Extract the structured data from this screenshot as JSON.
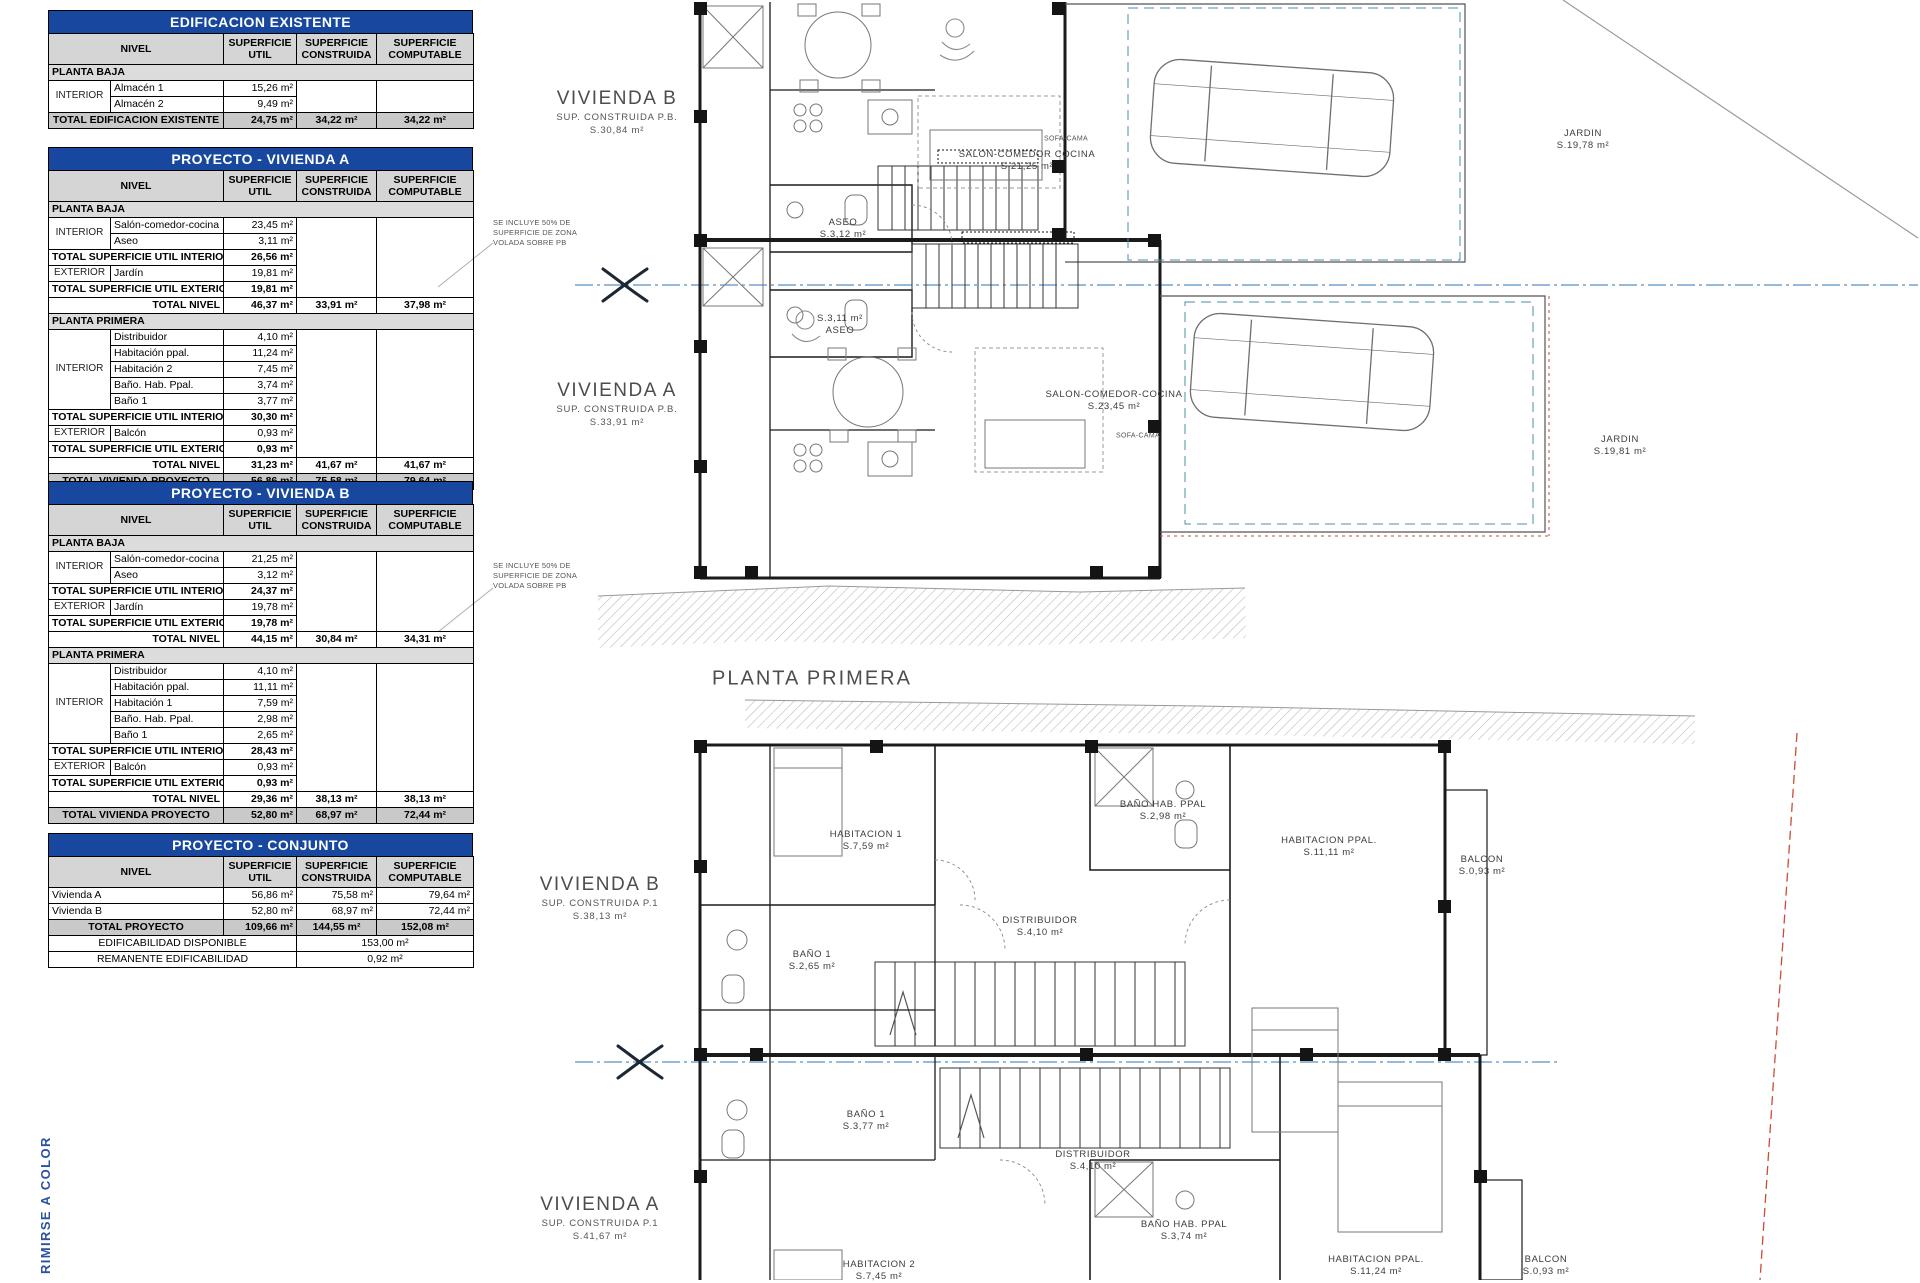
{
  "colors": {
    "accent_blue": "#17479e",
    "section_line_blue": "#2f74b5",
    "boundary_teal": "#4b8ca8",
    "boundary_red": "#cf4a38"
  },
  "side_note": "RIMIRSE A COLOR",
  "annotations": [
    {
      "x": 493,
      "y": 218,
      "lines": [
        "SE INCLUYE 50% DE",
        "SUPERFICIE DE ZONA",
        "VOLADA SOBRE PB"
      ]
    },
    {
      "x": 493,
      "y": 561,
      "lines": [
        "SE INCLUYE 50% DE",
        "SUPERFICIE DE ZONA",
        "VOLADA SOBRE PB"
      ]
    }
  ],
  "tables": [
    {
      "title": "EDIFICACION EXISTENTE",
      "headers": [
        "NIVEL",
        "SUPERFICIE UTIL",
        "SUPERFICIE CONSTRUIDA",
        "SUPERFICIE COMPUTABLE"
      ],
      "rows": [
        {
          "t": "section",
          "label": "PLANTA BAJA"
        },
        {
          "t": "item",
          "group": "INTERIOR",
          "gspan": 2,
          "name": "Almacén 1",
          "util": "15,26 m²",
          "cspan": 2
        },
        {
          "t": "item",
          "name": "Almacén 2",
          "util": "9,49 m²"
        },
        {
          "t": "grand",
          "label": "TOTAL EDIFICACION EXISTENTE",
          "util": "24,75 m²",
          "construida": "34,22 m²",
          "computable": "34,22 m²"
        }
      ]
    },
    {
      "title": "PROYECTO - VIVIENDA A",
      "headers": [
        "NIVEL",
        "SUPERFICIE UTIL",
        "SUPERFICIE CONSTRUIDA",
        "SUPERFICIE COMPUTABLE"
      ],
      "rows": [
        {
          "t": "section",
          "label": "PLANTA BAJA"
        },
        {
          "t": "item",
          "group": "INTERIOR",
          "gspan": 2,
          "name": "Salón-comedor-cocina",
          "util": "23,45 m²",
          "cspan": 5
        },
        {
          "t": "item",
          "name": "Aseo",
          "util": "3,11 m²"
        },
        {
          "t": "subtotal",
          "label": "TOTAL SUPERFICIE UTIL INTERIOR",
          "util": "26,56 m²"
        },
        {
          "t": "item",
          "group": "EXTERIOR",
          "gspan": 1,
          "name": "Jardín",
          "util": "19,81 m²"
        },
        {
          "t": "subtotal",
          "label": "TOTAL SUPERFICIE UTIL EXTERIOR",
          "util": "19,81 m²"
        },
        {
          "t": "level",
          "label": "TOTAL NIVEL",
          "util": "46,37 m²",
          "construida": "33,91 m²",
          "computable": "37,98 m²"
        },
        {
          "t": "section",
          "label": "PLANTA PRIMERA"
        },
        {
          "t": "item",
          "group": "INTERIOR",
          "gspan": 5,
          "name": "Distribuidor",
          "util": "4,10 m²",
          "cspan": 8
        },
        {
          "t": "item",
          "name": "Habitación ppal.",
          "util": "11,24 m²"
        },
        {
          "t": "item",
          "name": "Habitación 2",
          "util": "7,45 m²"
        },
        {
          "t": "item",
          "name": "Baño. Hab. Ppal.",
          "util": "3,74 m²"
        },
        {
          "t": "item",
          "name": "Baño 1",
          "util": "3,77 m²"
        },
        {
          "t": "subtotal",
          "label": "TOTAL SUPERFICIE UTIL INTERIOR",
          "util": "30,30 m²"
        },
        {
          "t": "item",
          "group": "EXTERIOR",
          "gspan": 1,
          "name": "Balcón",
          "util": "0,93 m²"
        },
        {
          "t": "subtotal",
          "label": "TOTAL SUPERFICIE UTIL EXTERIOR",
          "util": "0,93 m²"
        },
        {
          "t": "level",
          "label": "TOTAL NIVEL",
          "util": "31,23 m²",
          "construida": "41,67 m²",
          "computable": "41,67 m²"
        },
        {
          "t": "grand",
          "label": "TOTAL VIVIENDA PROYECTO",
          "util": "56,86 m²",
          "construida": "75,58 m²",
          "computable": "79,64 m²"
        }
      ]
    },
    {
      "title": "PROYECTO - VIVIENDA B",
      "headers": [
        "NIVEL",
        "SUPERFICIE UTIL",
        "SUPERFICIE CONSTRUIDA",
        "SUPERFICIE COMPUTABLE"
      ],
      "rows": [
        {
          "t": "section",
          "label": "PLANTA BAJA"
        },
        {
          "t": "item",
          "group": "INTERIOR",
          "gspan": 2,
          "name": "Salón-comedor-cocina",
          "util": "21,25 m²",
          "cspan": 5
        },
        {
          "t": "item",
          "name": "Aseo",
          "util": "3,12 m²"
        },
        {
          "t": "subtotal",
          "label": "TOTAL SUPERFICIE UTIL INTERIOR",
          "util": "24,37 m²"
        },
        {
          "t": "item",
          "group": "EXTERIOR",
          "gspan": 1,
          "name": "Jardín",
          "util": "19,78 m²"
        },
        {
          "t": "subtotal",
          "label": "TOTAL SUPERFICIE UTIL EXTERIOR",
          "util": "19,78 m²"
        },
        {
          "t": "level",
          "label": "TOTAL NIVEL",
          "util": "44,15 m²",
          "construida": "30,84 m²",
          "computable": "34,31 m²"
        },
        {
          "t": "section",
          "label": "PLANTA PRIMERA"
        },
        {
          "t": "item",
          "group": "INTERIOR",
          "gspan": 5,
          "name": "Distribuidor",
          "util": "4,10 m²",
          "cspan": 8
        },
        {
          "t": "item",
          "name": "Habitación ppal.",
          "util": "11,11 m²"
        },
        {
          "t": "item",
          "name": "Habitación 1",
          "util": "7,59 m²"
        },
        {
          "t": "item",
          "name": "Baño. Hab. Ppal.",
          "util": "2,98 m²"
        },
        {
          "t": "item",
          "name": "Baño 1",
          "util": "2,65 m²"
        },
        {
          "t": "subtotal",
          "label": "TOTAL SUPERFICIE UTIL INTERIOR",
          "util": "28,43 m²"
        },
        {
          "t": "item",
          "group": "EXTERIOR",
          "gspan": 1,
          "name": "Balcón",
          "util": "0,93 m²"
        },
        {
          "t": "subtotal",
          "label": "TOTAL SUPERFICIE UTIL EXTERIOR",
          "util": "0,93 m²"
        },
        {
          "t": "level",
          "label": "TOTAL NIVEL",
          "util": "29,36 m²",
          "construida": "38,13 m²",
          "computable": "38,13 m²"
        },
        {
          "t": "grand",
          "label": "TOTAL VIVIENDA PROYECTO",
          "util": "52,80 m²",
          "construida": "68,97 m²",
          "computable": "72,44 m²"
        }
      ]
    },
    {
      "title": "PROYECTO - CONJUNTO",
      "headers": [
        "NIVEL",
        "SUPERFICIE UTIL",
        "SUPERFICIE CONSTRUIDA",
        "SUPERFICIE COMPUTABLE"
      ],
      "rows": [
        {
          "t": "plain",
          "name": "Vivienda A",
          "util": "56,86 m²",
          "construida": "75,58 m²",
          "computable": "79,64 m²"
        },
        {
          "t": "plain",
          "name": "Vivienda B",
          "util": "52,80 m²",
          "construida": "68,97 m²",
          "computable": "72,44 m²"
        },
        {
          "t": "grand",
          "label": "TOTAL PROYECTO",
          "util": "109,66 m²",
          "construida": "144,55 m²",
          "computable": "152,08 m²"
        },
        {
          "t": "wide",
          "label": "EDIFICABILIDAD DISPONIBLE",
          "value": "153,00 m²"
        },
        {
          "t": "wide",
          "label": "REMANENTE EDIFICABILIDAD",
          "value": "0,92 m²"
        }
      ]
    }
  ],
  "plan": {
    "dwellings": [
      {
        "x": 617,
        "y": 88,
        "title": "VIVIENDA B",
        "subs": [
          "SUP. CONSTRUIDA P.B.",
          "S.30,84  m²"
        ]
      },
      {
        "x": 617,
        "y": 380,
        "title": "VIVIENDA A",
        "subs": [
          "SUP. CONSTRUIDA P.B.",
          "S.33,91  m²"
        ]
      },
      {
        "x": 600,
        "y": 874,
        "title": "VIVIENDA B",
        "subs": [
          "SUP. CONSTRUIDA P.1",
          "S.38,13  m²"
        ]
      },
      {
        "x": 600,
        "y": 1194,
        "title": "VIVIENDA A",
        "subs": [
          "SUP. CONSTRUIDA P.1",
          "S.41,67  m²"
        ]
      }
    ],
    "rooms": [
      {
        "x": 812,
        "y": 679,
        "cls": "plantitle",
        "lines": [
          "PLANTA PRIMERA"
        ]
      },
      {
        "x": 1027,
        "y": 161,
        "lines": [
          "SALON-COMEDOR COCINA",
          "S.21,25  m²"
        ]
      },
      {
        "x": 1066,
        "y": 140,
        "cls": "tiny",
        "lines": [
          "SOFA-CAMA"
        ]
      },
      {
        "x": 843,
        "y": 229,
        "lines": [
          "ASEO",
          "S.3,12  m²"
        ]
      },
      {
        "x": 840,
        "y": 325,
        "lines": [
          "S.3,11  m²",
          "ASEO"
        ]
      },
      {
        "x": 1114,
        "y": 401,
        "lines": [
          "SALON-COMEDOR-COCINA",
          "S.23,45  m²"
        ]
      },
      {
        "x": 1138,
        "y": 437,
        "cls": "tiny",
        "lines": [
          "SOFA-CAMA"
        ]
      },
      {
        "x": 1583,
        "y": 140,
        "lines": [
          "JARDIN",
          "S.19,78  m²"
        ]
      },
      {
        "x": 1620,
        "y": 446,
        "lines": [
          "JARDIN",
          "S.19,81  m²"
        ]
      },
      {
        "x": 866,
        "y": 841,
        "lines": [
          "HABITACION 1",
          "S.7,59  m²"
        ]
      },
      {
        "x": 1163,
        "y": 811,
        "lines": [
          "BAÑO HAB. PPAL",
          "S.2,98  m²"
        ]
      },
      {
        "x": 1329,
        "y": 847,
        "lines": [
          "HABITACION PPAL.",
          "S.11,11  m²"
        ]
      },
      {
        "x": 1482,
        "y": 866,
        "lines": [
          "BALCON",
          "S.0,93  m²"
        ]
      },
      {
        "x": 1040,
        "y": 927,
        "lines": [
          "DISTRIBUIDOR",
          "S.4,10  m²"
        ]
      },
      {
        "x": 812,
        "y": 961,
        "lines": [
          "BAÑO 1",
          "S.2,65  m²"
        ]
      },
      {
        "x": 866,
        "y": 1121,
        "lines": [
          "BAÑO 1",
          "S.3,77  m²"
        ]
      },
      {
        "x": 1093,
        "y": 1161,
        "lines": [
          "DISTRIBUIDOR",
          "S.4,10  m²"
        ]
      },
      {
        "x": 879,
        "y": 1271,
        "lines": [
          "HABITACION 2",
          "S.7,45  m²"
        ]
      },
      {
        "x": 1184,
        "y": 1231,
        "lines": [
          "BAÑO HAB. PPAL",
          "S.3,74  m²"
        ]
      },
      {
        "x": 1376,
        "y": 1266,
        "lines": [
          "HABITACION PPAL.",
          "S.11,24  m²"
        ]
      },
      {
        "x": 1546,
        "y": 1266,
        "lines": [
          "BALCON",
          "S.0,93  m²"
        ]
      }
    ]
  }
}
